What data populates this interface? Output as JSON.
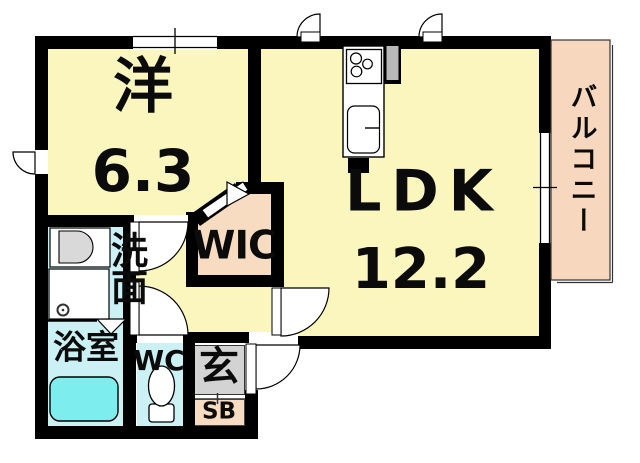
{
  "plan": {
    "type": "apartment-floorplan",
    "rooms": {
      "bedroom": {
        "label": "洋",
        "size": "6.3"
      },
      "ldk": {
        "label": "LDK",
        "size": "12.2"
      },
      "wic": {
        "label": "WIC"
      },
      "washroom": {
        "label": "洗面"
      },
      "bathroom": {
        "label": "浴室"
      },
      "wc": {
        "label": "WC"
      },
      "entrance": {
        "label": "玄"
      },
      "shoebox": {
        "label": "SB"
      },
      "balcony": {
        "label": "バルコニー"
      }
    },
    "fixtures": [
      "kitchen-stove",
      "kitchen-sink",
      "washbasin",
      "washing-machine",
      "bathtub",
      "toilet"
    ],
    "colors": {
      "floor_yellow": "#FAF6BE",
      "closet_peach": "#F8DCC2",
      "balcony_peach": "#F7D8BE",
      "wet_area_cyan": "#CBF1F4",
      "bathtub_cyan": "#7EEDED",
      "entrance_gray": "#D3D3D3",
      "wall_black": "#000000"
    }
  }
}
